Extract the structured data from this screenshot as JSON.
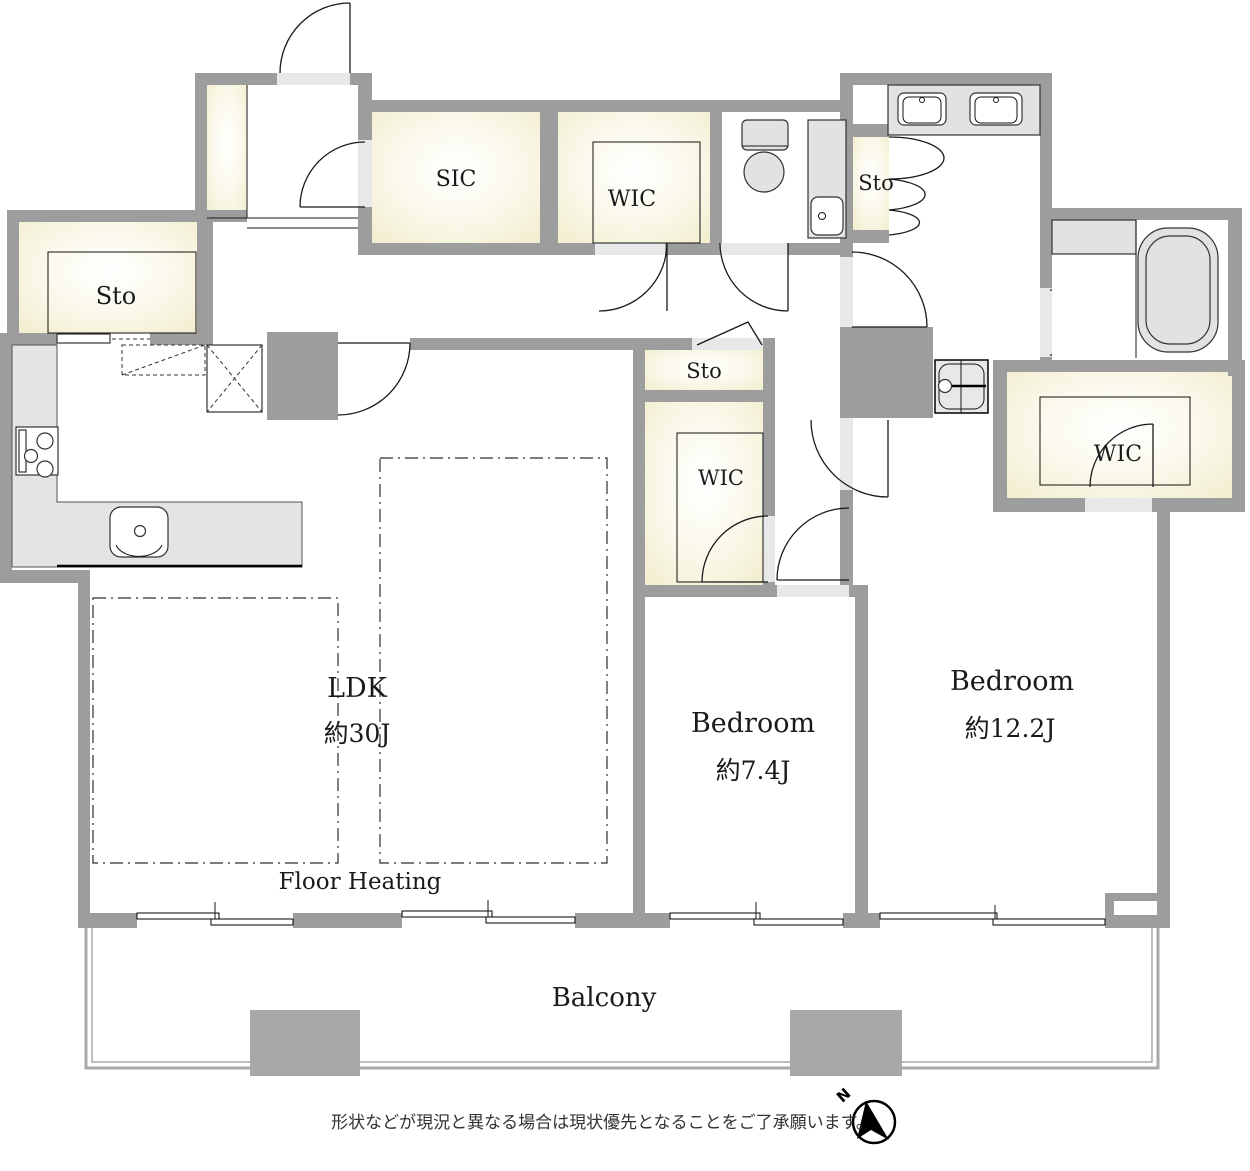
{
  "page": {
    "type": "floor-plan"
  },
  "colors": {
    "wall_gray": "#9d9d9d",
    "opening_gray": "#e8e8e8",
    "pillar_gray": "#a8a8a8",
    "room_cream": "#f0ebc9",
    "fixture_gray": "#e2e2e2",
    "line_black": "#1a1a1a"
  },
  "rooms": {
    "sic": {
      "label": "SIC"
    },
    "wic_top": {
      "label": "WIC"
    },
    "sto_left": {
      "label": "Sto"
    },
    "sto_wash": {
      "label": "Sto"
    },
    "sto_mid": {
      "label": "Sto"
    },
    "wic_mid": {
      "label": "WIC"
    },
    "wic_right": {
      "label": "WIC"
    },
    "ldk": {
      "label": "LDK",
      "size": "約30J"
    },
    "bedroom_small": {
      "label": "Bedroom",
      "size": "約7.4J"
    },
    "bedroom_large": {
      "label": "Bedroom",
      "size": "約12.2J"
    },
    "balcony": {
      "label": "Balcony"
    },
    "floor_heating": {
      "label": "Floor Heating"
    }
  },
  "compass": {
    "label": "N"
  },
  "footer": {
    "disclaimer": "形状などが現況と異なる場合は現状優先となることをご了承願います。"
  }
}
